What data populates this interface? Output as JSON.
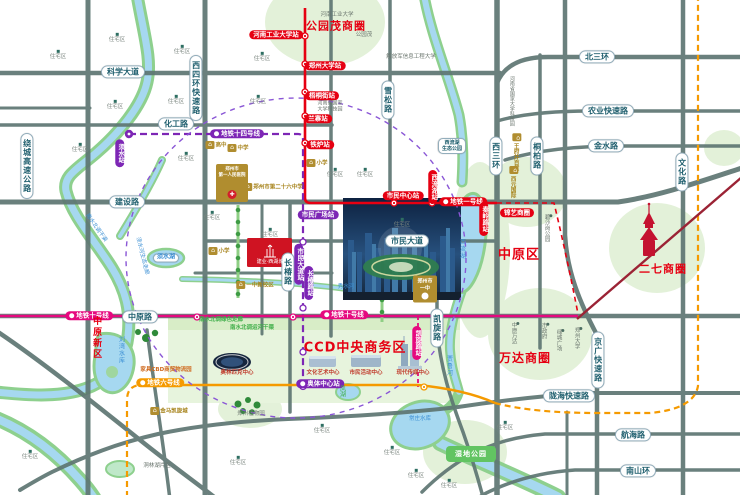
{
  "map": {
    "legend_colors": {
      "metro_line_1": "#e60012",
      "metro_line_6": "#f59a00",
      "metro_line_10": "#e5097f",
      "metro_line_14": "#7d26b5",
      "business_circle_text": "#e60012",
      "road_label_text": "#1f5f6e",
      "water": "#a6d8f0",
      "park": "#e3f1d9"
    },
    "labels": [
      {
        "n": "road-kexuedadao",
        "s": "pill",
        "x": 123,
        "y": 72,
        "t": "科学大道"
      },
      {
        "n": "road-huagonglu",
        "s": "pill",
        "x": 176,
        "y": 124,
        "t": "化工路"
      },
      {
        "n": "road-jianshelu",
        "s": "pill",
        "x": 127,
        "y": 202,
        "t": "建设路"
      },
      {
        "n": "road-beisanhuan",
        "s": "pill",
        "x": 597,
        "y": 57,
        "t": "北三环"
      },
      {
        "n": "road-nongye-expwy",
        "s": "pill",
        "x": 608,
        "y": 111,
        "t": "农业快速路"
      },
      {
        "n": "road-jinshuilu",
        "s": "pill",
        "x": 606,
        "y": 146,
        "t": "金水路"
      },
      {
        "n": "road-zhongyuanlu",
        "s": "pill",
        "x": 140,
        "y": 317,
        "t": "中原路"
      },
      {
        "n": "road-shimindadao",
        "s": "pill",
        "x": 407,
        "y": 241,
        "t": "市民大道"
      },
      {
        "n": "road-longhai-expwy",
        "s": "pill",
        "x": 569,
        "y": 396,
        "t": "陇海快速路"
      },
      {
        "n": "road-hanghailu",
        "s": "pill",
        "x": 633,
        "y": 435,
        "t": "航海路"
      },
      {
        "n": "road-nanshanhuan",
        "s": "pill",
        "x": 638,
        "y": 471,
        "t": "南山环"
      },
      {
        "n": "road-xisihuan-expwy",
        "s": "pillv",
        "x": 196,
        "y": 88,
        "t": "西四环快速路"
      },
      {
        "n": "road-raocheng-expwy",
        "s": "pillv",
        "x": 27,
        "y": 166,
        "t": "绕城高速公路"
      },
      {
        "n": "road-xisanhuan",
        "s": "pillv",
        "x": 496,
        "y": 156,
        "t": "西三环"
      },
      {
        "n": "road-wenhualu",
        "s": "pillv",
        "x": 682,
        "y": 172,
        "t": "文化路"
      },
      {
        "n": "road-tongbailu",
        "s": "pillv",
        "x": 537,
        "y": 156,
        "t": "桐柏路"
      },
      {
        "n": "road-xuesonglu",
        "s": "pillv",
        "x": 388,
        "y": 100,
        "t": "雪松路"
      },
      {
        "n": "road-changchunlu",
        "s": "pillv",
        "x": 288,
        "y": 272,
        "t": "长椿路"
      },
      {
        "n": "road-kaixuanlu",
        "s": "pillv",
        "x": 437,
        "y": 328,
        "t": "凯旋路"
      },
      {
        "n": "road-jingguang-expwy",
        "s": "pillv",
        "x": 598,
        "y": 360,
        "t": "京广快速路"
      },
      {
        "n": "poi-xiliuhu-eco-park",
        "s": "pill2",
        "x": 452,
        "y": 146,
        "t": "西流湖\n生态公园"
      },
      {
        "n": "station-henangongye",
        "s": "red",
        "x": 276,
        "y": 35,
        "t": "河南工业大学站"
      },
      {
        "n": "station-zhengzhoudaxue",
        "s": "red",
        "x": 325,
        "y": 66,
        "t": "郑州大学站"
      },
      {
        "n": "station-wutongjie",
        "s": "red",
        "x": 322,
        "y": 96,
        "t": "梧桐街站"
      },
      {
        "n": "station-lanzhai",
        "s": "red",
        "x": 318,
        "y": 119,
        "t": "兰寨站"
      },
      {
        "n": "station-tielu",
        "s": "red",
        "x": 320,
        "y": 145,
        "t": "铁炉站"
      },
      {
        "n": "station-shiminzhongxin",
        "s": "red",
        "x": 403,
        "y": 196,
        "t": "市民中心站"
      },
      {
        "n": "line1-label",
        "s": "red",
        "i": 1,
        "x": 463,
        "y": 202,
        "t": "地铁一号线"
      },
      {
        "n": "station-xiliuhu",
        "s": "redv",
        "x": 433,
        "y": 187,
        "t": "西流湖站"
      },
      {
        "n": "station-qinlinglu",
        "s": "redv",
        "x": 484,
        "y": 219,
        "t": "秦岭路站"
      },
      {
        "n": "line14-label",
        "s": "pur",
        "i": 1,
        "x": 237,
        "y": 134,
        "t": "地铁十四号线"
      },
      {
        "n": "station-xushui",
        "s": "purv",
        "x": 120,
        "y": 153,
        "t": "须水站"
      },
      {
        "n": "station-shiminguangchang",
        "s": "pur",
        "x": 318,
        "y": 215,
        "t": "市民广场站"
      },
      {
        "n": "station-shimindadao",
        "s": "purv",
        "x": 299,
        "y": 264,
        "t": "市民大道站"
      },
      {
        "n": "station-changchunlu",
        "s": "purv",
        "x": 309,
        "y": 283,
        "t": "长椿路站"
      },
      {
        "n": "station-aotizhongxin",
        "s": "pur",
        "i": 1,
        "x": 320,
        "y": 384,
        "t": "奥体中心站"
      },
      {
        "n": "line10-label-west",
        "s": "mag",
        "i": 1,
        "x": 89,
        "y": 316,
        "t": "地铁十号线"
      },
      {
        "n": "line10-label-east",
        "s": "mag",
        "i": 1,
        "x": 344,
        "y": 315,
        "t": "地铁十号线"
      },
      {
        "n": "station-kaixuanlu",
        "s": "magv",
        "x": 417,
        "y": 343,
        "t": "凯旋路站"
      },
      {
        "n": "line6-label",
        "s": "org",
        "i": 1,
        "x": 160,
        "y": 383,
        "t": "地铁六号线"
      },
      {
        "n": "biz-gongyuanmao",
        "s": "biz",
        "x": 336,
        "y": 27,
        "fs": 11,
        "t": "公园茂商圈"
      },
      {
        "n": "biz-jinyi",
        "s": "red",
        "x": 517,
        "y": 213,
        "t": "锦艺商圈"
      },
      {
        "n": "biz-wanda",
        "s": "biz",
        "x": 525,
        "y": 359,
        "fs": 12,
        "t": "万达商圈"
      },
      {
        "n": "district-zhongyuanqu",
        "s": "biz",
        "x": 519,
        "y": 256,
        "fs": 13,
        "t": "中原区"
      },
      {
        "n": "biz-erqi",
        "s": "biz",
        "x": 663,
        "y": 270,
        "fs": 11,
        "t": "二七商圈"
      },
      {
        "n": "ccd-title",
        "s": "biz",
        "x": 355,
        "y": 349,
        "fs": 13,
        "t": "CCD中央商务区"
      },
      {
        "n": "poi-henan-univ-tech",
        "s": "gray",
        "x": 337,
        "y": 15,
        "t": "河南工业大学"
      },
      {
        "n": "poi-pla-univ",
        "s": "gray",
        "x": 411,
        "y": 57,
        "t": "解放军信息工程大学"
      },
      {
        "n": "poi-gongyuanmao",
        "s": "gray",
        "x": 364,
        "y": 35,
        "t": "公园茂"
      },
      {
        "n": "poi-keji-park-2line",
        "s": "gray2",
        "x": 330,
        "y": 107,
        "t": "河南省国家\n大学科技园"
      },
      {
        "n": "poi-keji-park-v",
        "s": "grayv",
        "x": 511,
        "y": 101,
        "fs": 5,
        "t": "河南省国家大学科技园"
      },
      {
        "n": "poi-bishagang-park",
        "s": "grayv dot",
        "x": 548,
        "y": 228,
        "t": "碧沙岗公园"
      },
      {
        "n": "poi-shizhengfu",
        "s": "grayv dot",
        "x": 545,
        "y": 331,
        "t": "市政府"
      },
      {
        "n": "poi-lvcheng-square",
        "s": "grayv dot",
        "x": 560,
        "y": 340,
        "t": "绿城广场"
      },
      {
        "n": "poi-zhengzhou-univ",
        "s": "grayv dot",
        "x": 578,
        "y": 338,
        "t": "郑州大学"
      },
      {
        "n": "poi-zhongyuan-wanda",
        "s": "grayv dot",
        "x": 515,
        "y": 333,
        "t": "中原万达"
      },
      {
        "n": "poi-botanical-garden",
        "s": "gray",
        "x": 251,
        "y": 414,
        "t": "郑州植物园"
      },
      {
        "n": "poi-donglinhu",
        "s": "gray",
        "x": 157,
        "y": 466,
        "t": "洞林湖片区"
      },
      {
        "n": "district-zhongyuanxinqu",
        "s": "redbigv",
        "x": 96,
        "y": 338,
        "t": "中原新区"
      },
      {
        "n": "water-xiliuhu",
        "s": "bluev",
        "x": 461,
        "y": 249,
        "t": "西流湖"
      },
      {
        "n": "water-jialuhe",
        "s": "bluev",
        "x": 448,
        "y": 366,
        "t": "贾鲁河"
      },
      {
        "n": "water-changzhuang-reservoir",
        "s": "blue",
        "x": 420,
        "y": 419,
        "t": "常庄水库"
      },
      {
        "n": "water-xushuihu",
        "s": "bluepill",
        "x": 166,
        "y": 258,
        "t": "须水湖"
      },
      {
        "n": "water-liuwan-reservoir",
        "s": "bluev",
        "x": 120,
        "y": 350,
        "t": "刘湾水库"
      },
      {
        "n": "water-xiushuihe",
        "s": "blue",
        "x": 346,
        "y": 287,
        "t": "秀水河"
      },
      {
        "n": "water-nanshuibeidiao",
        "s": "blue",
        "x": 96,
        "y": 228,
        "r": 55,
        "t": "南水北调干渠"
      },
      {
        "n": "water-xushuihe-corridor",
        "s": "blue",
        "x": 142,
        "y": 256,
        "r": 76,
        "t": "须水河生态走廊"
      },
      {
        "n": "green-corridor",
        "s": "green",
        "x": 221,
        "y": 320,
        "t": "南水北调绿色走廊"
      },
      {
        "n": "green-canal",
        "s": "green",
        "x": 252,
        "y": 328,
        "t": "南水北调运河干渠"
      },
      {
        "n": "water-fenghu",
        "s": "greenv",
        "x": 341,
        "y": 391,
        "t": "凤湖"
      },
      {
        "n": "poi-shidi-park",
        "s": "greenrect",
        "x": 471,
        "y": 454,
        "t": "湿地公园"
      },
      {
        "n": "poi-gaozhong",
        "s": "poi",
        "x": 216,
        "y": 145,
        "t": "高中"
      },
      {
        "n": "poi-zhongxue",
        "s": "poi",
        "x": 238,
        "y": 148,
        "t": "中学"
      },
      {
        "n": "poi-no26-school",
        "s": "poi",
        "x": 273,
        "y": 187,
        "t": "郑州市第二十六中学"
      },
      {
        "n": "poi-xiaoxue-1",
        "s": "poi",
        "x": 317,
        "y": 163,
        "t": "小学"
      },
      {
        "n": "poi-xiaoxue-2",
        "s": "poi",
        "x": 219,
        "y": 251,
        "t": "小学"
      },
      {
        "n": "poi-yizhong-new-campus",
        "s": "poi",
        "x": 255,
        "y": 285,
        "t": "一中新校区"
      },
      {
        "n": "poi-jinma-kaixuan",
        "s": "poi",
        "x": 169,
        "y": 411,
        "t": "金马凯旋城"
      },
      {
        "n": "poi-jiaju-cbd",
        "s": "goldtext",
        "x": 166,
        "y": 370,
        "t": "家具CBD商贸物流园"
      },
      {
        "n": "poi-wangfujing",
        "s": "poiv",
        "x": 517,
        "y": 152,
        "t": "王府井百货"
      },
      {
        "n": "poi-xiyuan-intl",
        "s": "poiv",
        "x": 514,
        "y": 182,
        "t": "西元国际"
      },
      {
        "n": "poi-hospital",
        "s": "hospital",
        "x": 232,
        "y": 183,
        "t": "郑州市\n第一人民医院"
      },
      {
        "n": "poi-yizhong",
        "s": "school",
        "x": 425,
        "y": 289,
        "t": "郑州市\n一中"
      },
      {
        "n": "project-parcel-label",
        "s": "white",
        "x": 270,
        "y": 263,
        "t": "建业·西湖城"
      },
      {
        "n": "poi-olympic-center",
        "s": "redsm",
        "x": 237,
        "y": 373,
        "t": "奥林匹克中心"
      },
      {
        "n": "poi-culture-art-center",
        "s": "redsm",
        "x": 323,
        "y": 373,
        "t": "文化艺术中心"
      },
      {
        "n": "poi-civic-activity-center",
        "s": "redsm",
        "x": 366,
        "y": 373,
        "t": "市民活动中心"
      },
      {
        "n": "poi-media-center",
        "s": "redsm",
        "x": 413,
        "y": 373,
        "t": "现代传媒中心"
      },
      {
        "n": "res-1",
        "s": "res",
        "x": 117,
        "y": 38,
        "t": "住宅区"
      },
      {
        "n": "res-2",
        "s": "res",
        "x": 58,
        "y": 55,
        "t": "住宅区"
      },
      {
        "n": "res-3",
        "s": "res",
        "x": 182,
        "y": 50,
        "t": "住宅区"
      },
      {
        "n": "res-4",
        "s": "res",
        "x": 115,
        "y": 105,
        "t": "住宅区"
      },
      {
        "n": "res-5",
        "s": "res",
        "x": 176,
        "y": 100,
        "t": "住宅区"
      },
      {
        "n": "res-6",
        "s": "res",
        "x": 80,
        "y": 148,
        "t": "住宅区"
      },
      {
        "n": "res-7",
        "s": "res",
        "x": 186,
        "y": 157,
        "t": "住宅区"
      },
      {
        "n": "res-8",
        "s": "res",
        "x": 262,
        "y": 57,
        "t": "住宅区"
      },
      {
        "n": "res-9",
        "s": "res",
        "x": 258,
        "y": 100,
        "t": "住宅区"
      },
      {
        "n": "res-10",
        "s": "res",
        "x": 212,
        "y": 216,
        "t": "住宅区"
      },
      {
        "n": "res-11",
        "s": "res",
        "x": 270,
        "y": 233,
        "t": "住宅区"
      },
      {
        "n": "res-12",
        "s": "res",
        "x": 335,
        "y": 173,
        "t": "住宅区"
      },
      {
        "n": "res-13",
        "s": "res",
        "x": 365,
        "y": 173,
        "t": "住宅区"
      },
      {
        "n": "res-14",
        "s": "res",
        "x": 402,
        "y": 223,
        "t": "住宅区"
      },
      {
        "n": "res-15",
        "s": "res",
        "x": 322,
        "y": 429,
        "t": "住宅区"
      },
      {
        "n": "res-16",
        "s": "res",
        "x": 392,
        "y": 451,
        "t": "住宅区"
      },
      {
        "n": "res-17",
        "s": "res",
        "x": 416,
        "y": 474,
        "t": "住宅区"
      },
      {
        "n": "res-18",
        "s": "res",
        "x": 449,
        "y": 484,
        "t": "住宅区"
      },
      {
        "n": "res-19",
        "s": "res",
        "x": 238,
        "y": 461,
        "t": "住宅区"
      },
      {
        "n": "res-20",
        "s": "res",
        "x": 505,
        "y": 426,
        "t": "住宅区"
      },
      {
        "n": "res-21",
        "s": "res",
        "x": 30,
        "y": 455,
        "t": "住宅区"
      }
    ]
  }
}
